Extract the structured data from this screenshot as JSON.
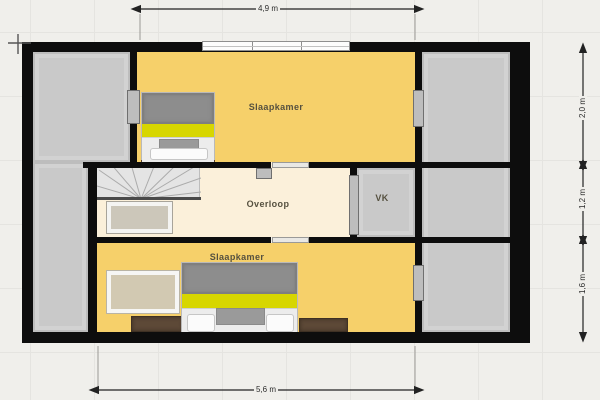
{
  "plan_title": "floor-plan",
  "rooms": {
    "bedroom_top": "Slaapkamer",
    "landing": "Overloop",
    "closet": "VK",
    "bedroom_bottom": "Slaapkamer"
  },
  "dimensions": {
    "top_width": "4,9 m",
    "bottom_width": "5,6 m",
    "right_upper": "2,0 m",
    "right_middle": "1,2 m",
    "right_lower": "1,6 m"
  },
  "colors": {
    "canvas_bg": "#f0efeb",
    "wall": "#0d0d0d",
    "bedroom_fill": "#f6d06a",
    "landing_fill": "#fbf0da",
    "storage_fill": "#c9c9c9",
    "accent_stripe": "#d7d600"
  }
}
